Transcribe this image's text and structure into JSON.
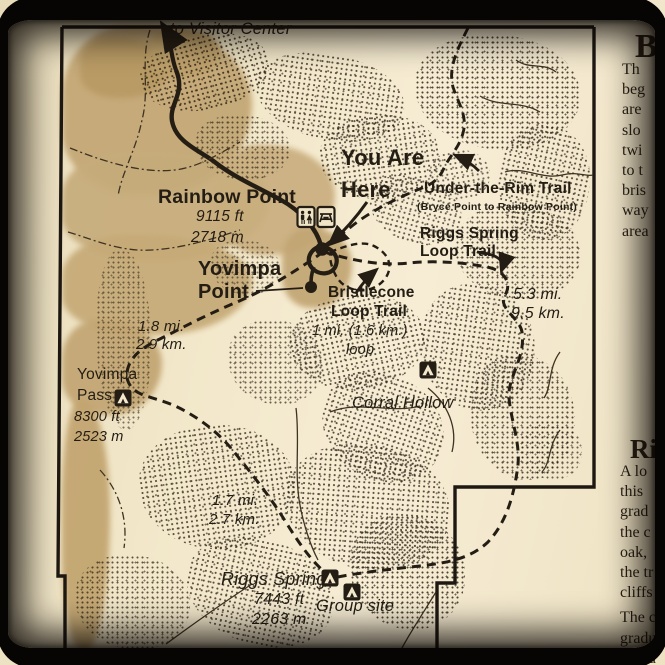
{
  "title": "Trailhead map sign — Rainbow Point / Yovimpa Point (Bryce Canyon)",
  "colors": {
    "sign_cream": "#f3e8cc",
    "map_ink": "#241d14",
    "terrain_tan": "#c5aa77",
    "frame_black": "#070503"
  },
  "icons": [
    "up-arrow-icon",
    "restroom-icon",
    "picnic-table-icon",
    "campsite-icon",
    "you-are-here-dot",
    "trail-arrow-icon"
  ],
  "map_labels": {
    "to_visitor_center": "to Visitor Center",
    "you_are_here_line1": "You Are",
    "you_are_here_line2": "Here",
    "rainbow_point": "Rainbow Point",
    "rainbow_point_ft": "9115 ft",
    "rainbow_point_m": "2718 m",
    "under_the_rim": "Under-the-Rim Trail",
    "under_the_rim_sub": "(Bryce Point to Rainbow Point)",
    "riggs_loop_line1": "Riggs Spring",
    "riggs_loop_line2": "Loop Trail",
    "yovimpa_line1": "Yovimpa",
    "yovimpa_line2": "Point",
    "bristlecone_line1": "Bristlecone",
    "bristlecone_line2": "Loop Trail",
    "bristlecone_dist": "1 mi. (1.6 km.)",
    "bristlecone_loop_word": "loop",
    "dist_5_3_mi": "5.3 mi.",
    "dist_9_5_km": "9.5 km.",
    "dist_1_8_mi": "1.8 mi.",
    "dist_2_9_km": "2.9 km.",
    "yovimpa_pass_line1": "Yovimpa",
    "yovimpa_pass_line2": "Pass",
    "yovimpa_pass_ft": "8300 ft",
    "yovimpa_pass_m": "2523 m",
    "corral_hollow": "Corral Hollow",
    "dist_1_7_mi": "1.7 mi.",
    "dist_2_7_km": "2.7 km.",
    "riggs_spring": "Riggs Spring",
    "riggs_spring_ft": "7443 ft",
    "riggs_spring_m": "2263 m",
    "group_site": "Group site"
  },
  "side_text": {
    "block1_heading": "B",
    "block1_lines": [
      "Th",
      "beg",
      "are",
      "slo",
      "twi",
      "to t",
      "bris",
      "way",
      "area"
    ],
    "block2_heading": "Rig",
    "block2_lines": [
      "A lo",
      "this",
      "grad",
      "the c",
      "oak,",
      "the tr",
      "cliffs",
      "The c",
      "gradu",
      "east a"
    ]
  }
}
